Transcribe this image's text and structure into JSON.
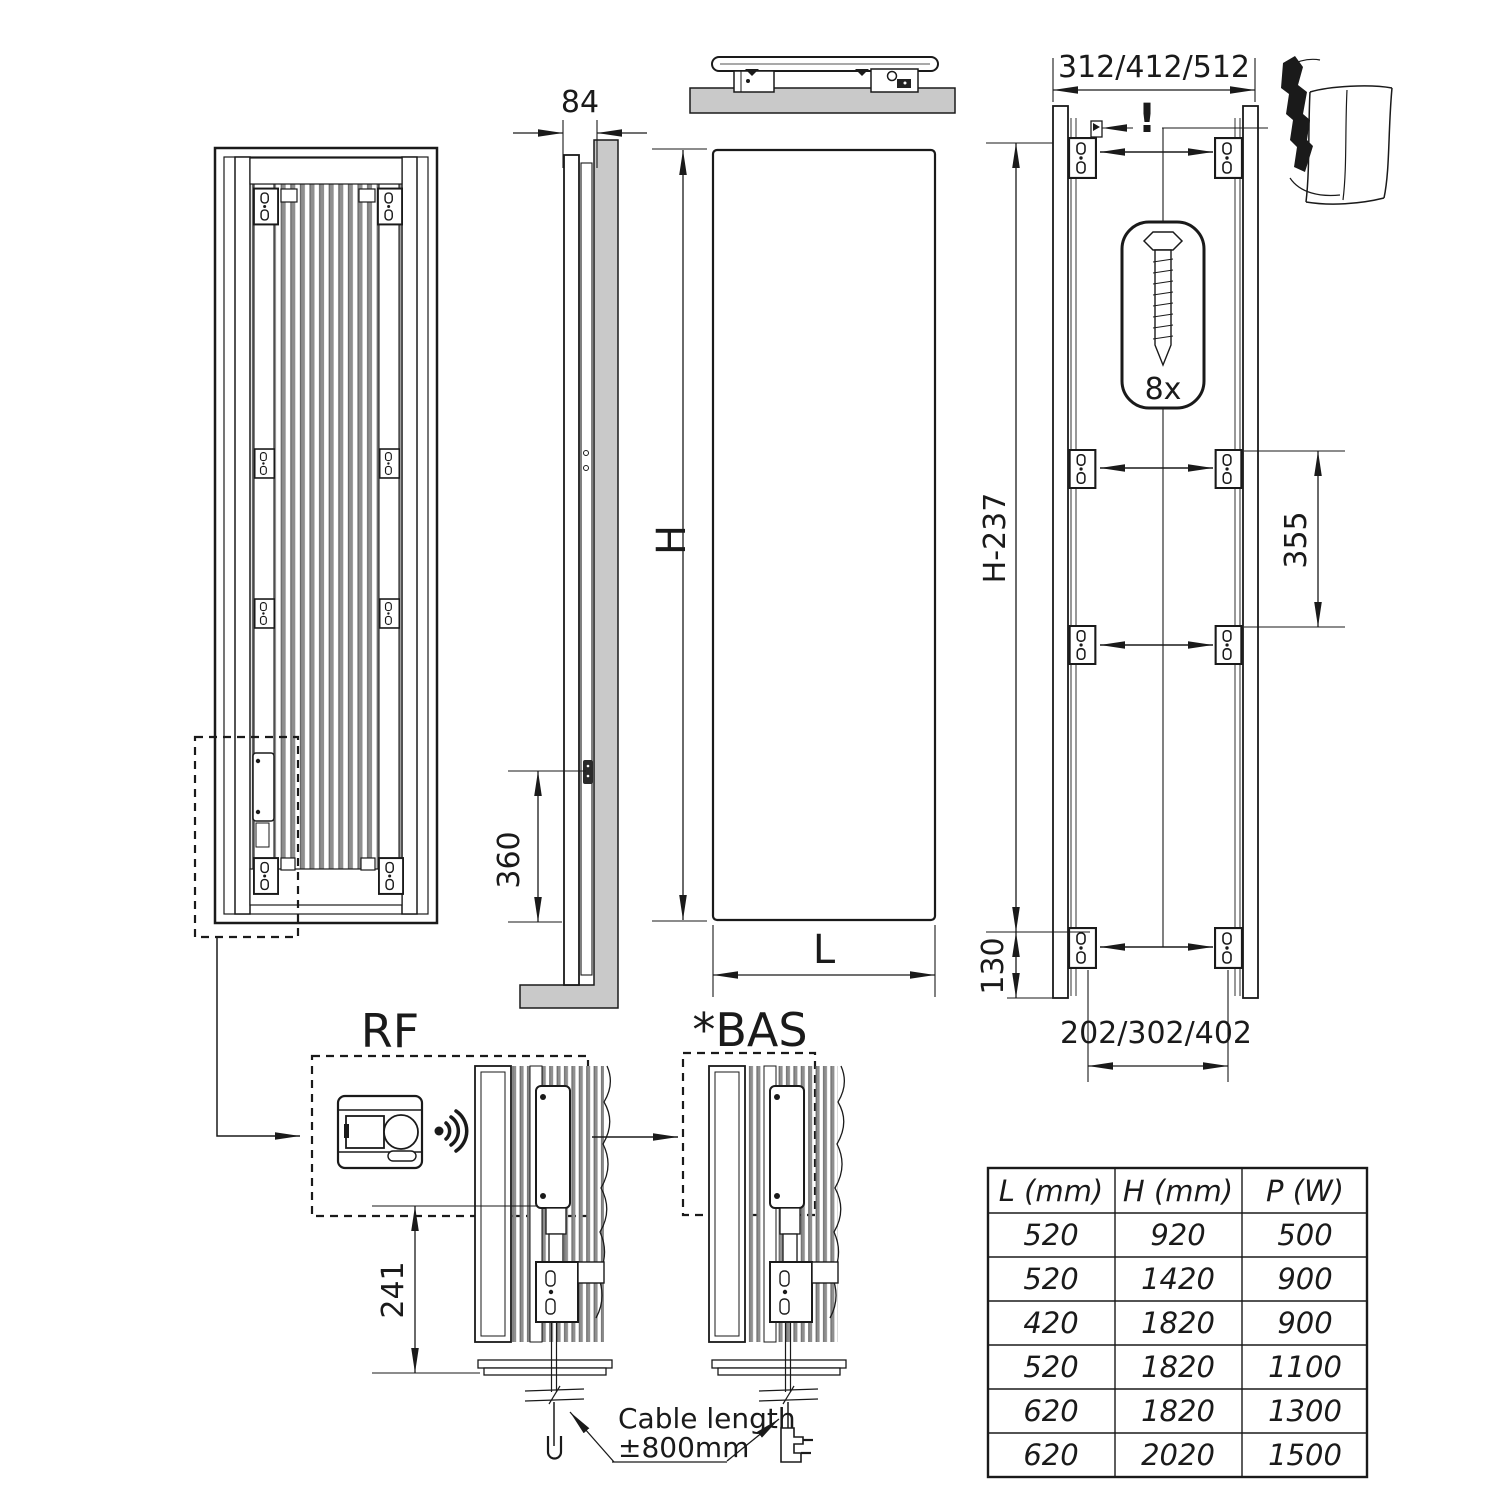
{
  "dims": {
    "depth": "84",
    "inlet_height": "360",
    "height_label": "H",
    "width_label": "L",
    "top_bracket_spacing": "312/412/512",
    "bracket_frame_height": "H-237",
    "mid_bracket_spacing": "355",
    "bottom_offset": "130",
    "bottom_bracket_spacing": "202/302/402",
    "control_unit_height": "241"
  },
  "annotations": {
    "warning": "!",
    "screw_quantity": "8x",
    "rf_label": "RF",
    "bas_label": "*BAS",
    "cable_note_line1": "Cable length",
    "cable_note_line2": "±800mm"
  },
  "table": {
    "headers": [
      "L (mm)",
      "H (mm)",
      "P (W)"
    ],
    "rows": [
      [
        "520",
        "920",
        "500"
      ],
      [
        "520",
        "1420",
        "900"
      ],
      [
        "420",
        "1820",
        "900"
      ],
      [
        "520",
        "1820",
        "1100"
      ],
      [
        "620",
        "1820",
        "1300"
      ],
      [
        "620",
        "2020",
        "1500"
      ]
    ]
  },
  "colors": {
    "line": "#1a1a1a",
    "wall": "#c9c9c9",
    "fin": "#8f8f8f",
    "background": "#ffffff"
  }
}
